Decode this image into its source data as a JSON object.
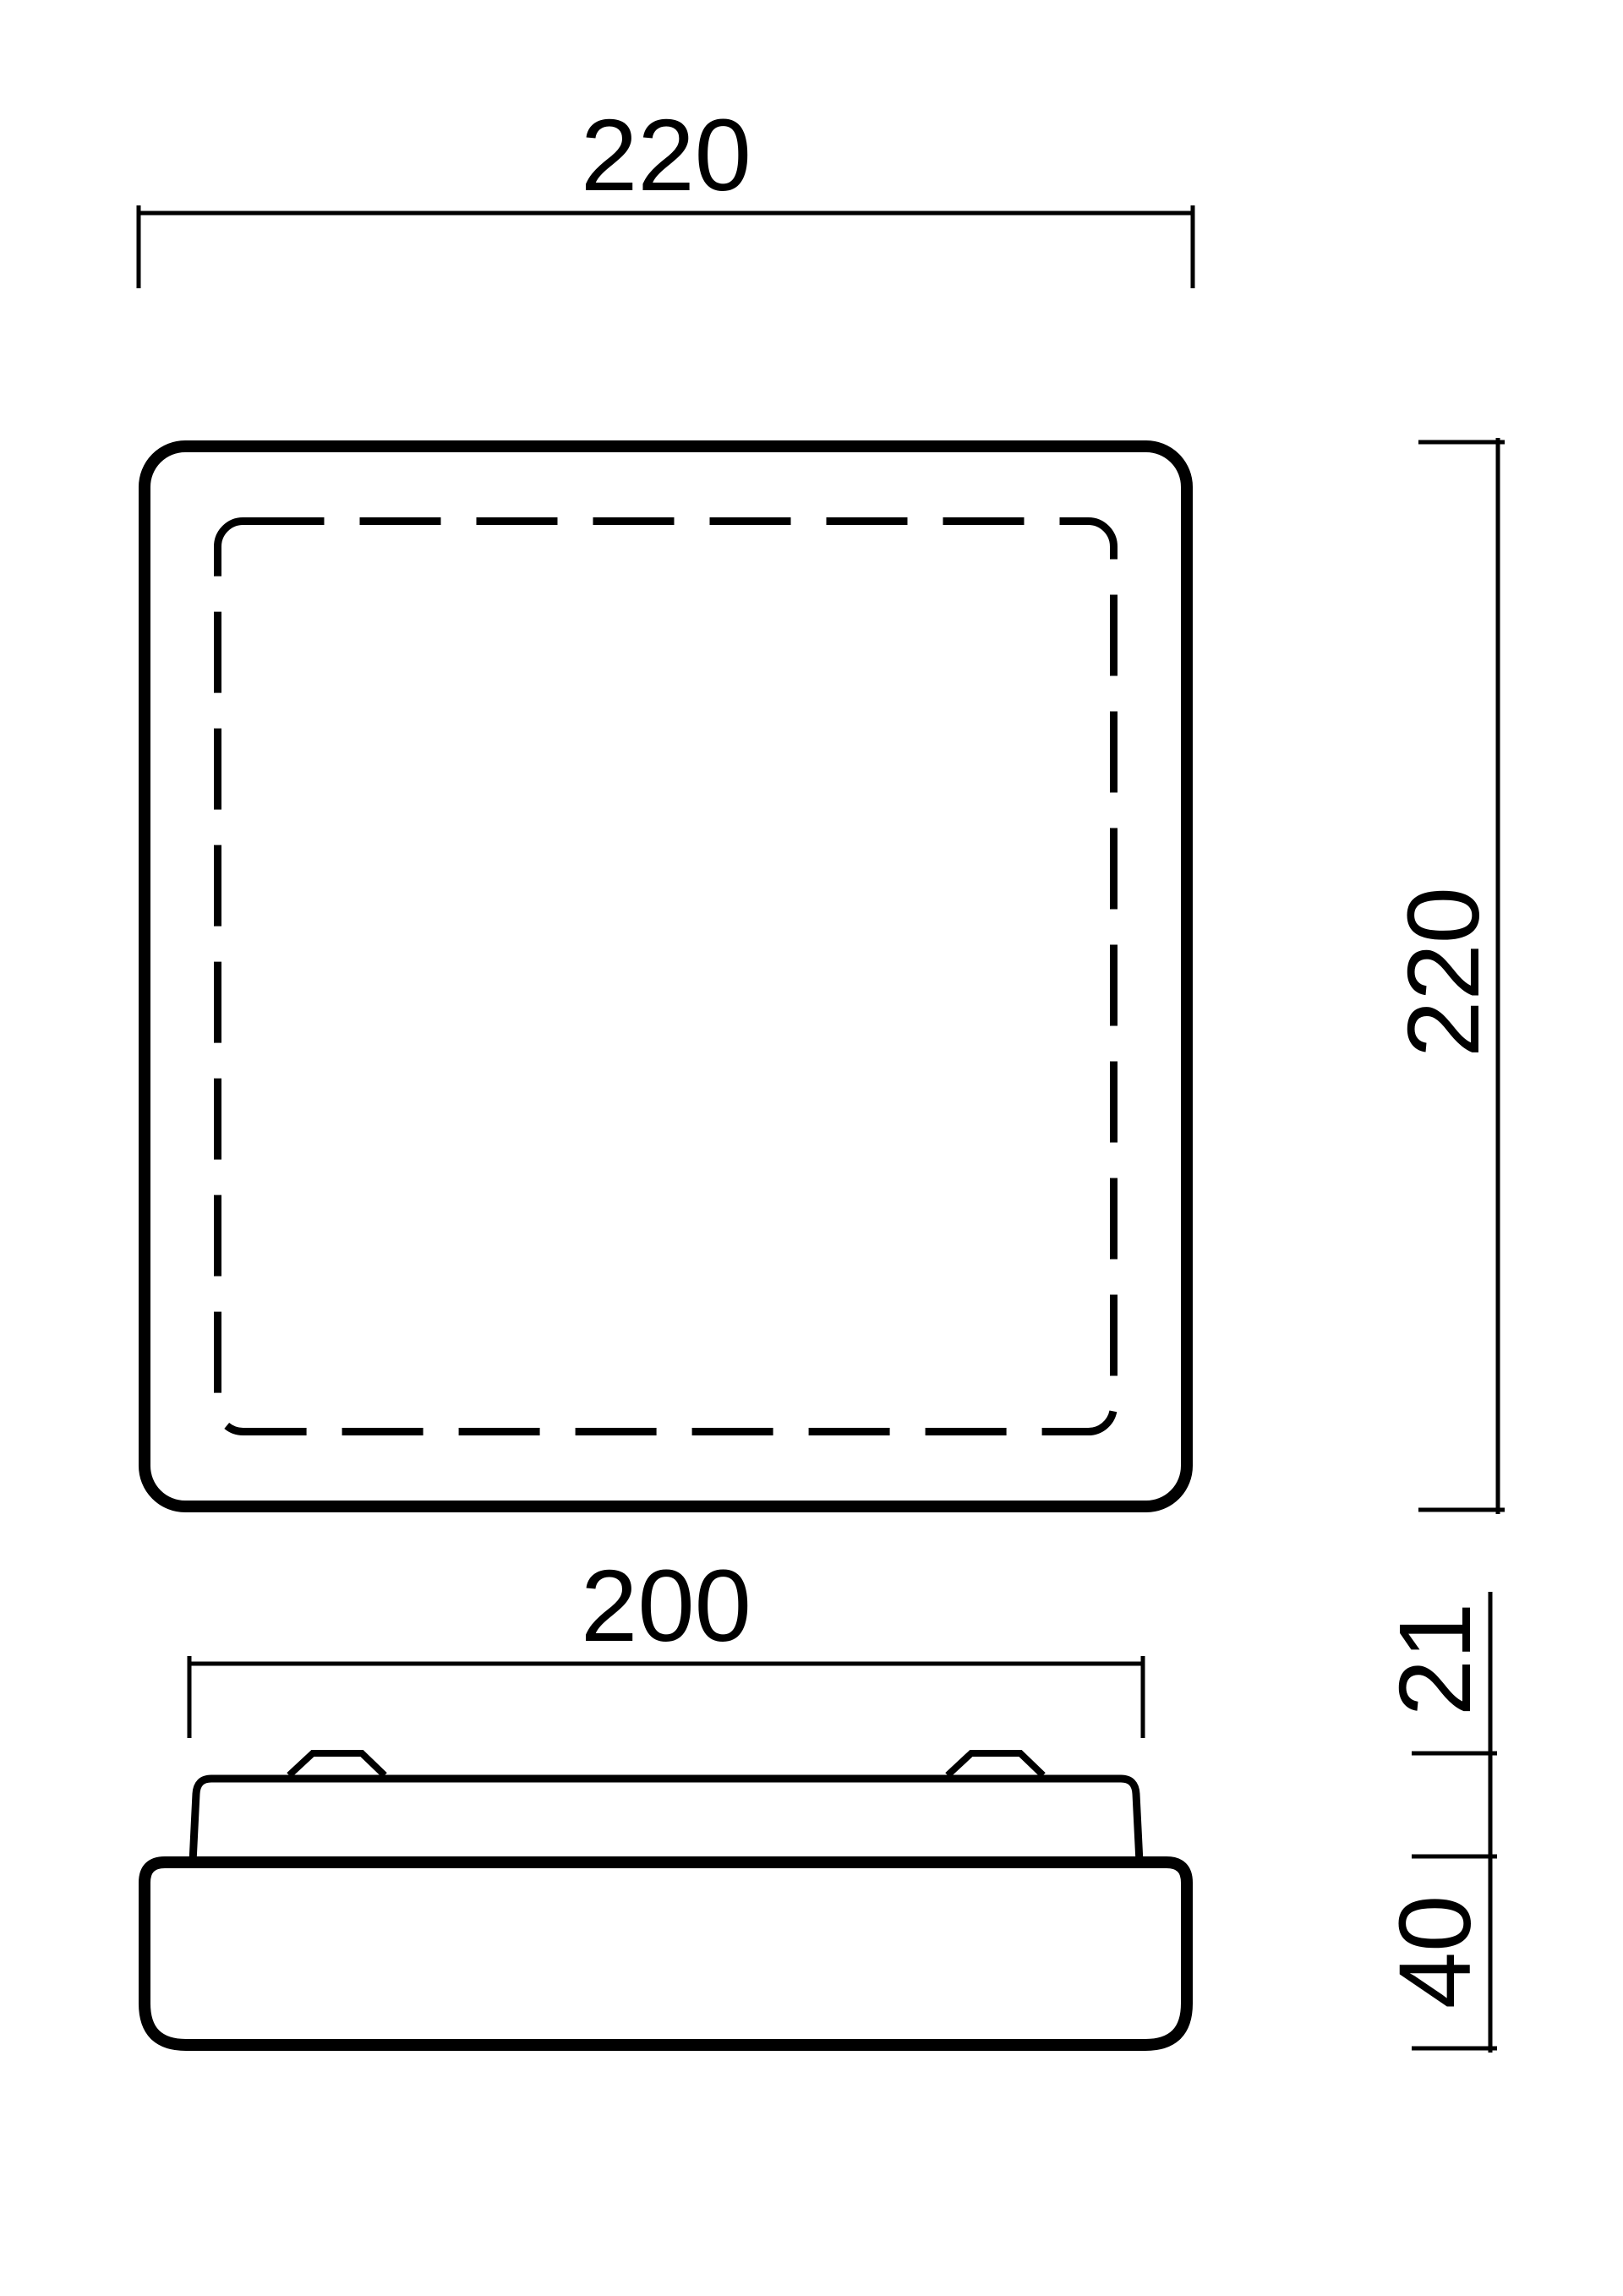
{
  "colors": {
    "background": "#ffffff",
    "line": "#000000"
  },
  "drawing": {
    "dimensions": {
      "top_view_width": "220",
      "top_view_height": "220",
      "front_view_width": "200",
      "front_view_diffuser_height": "21",
      "front_view_base_height": "40"
    }
  }
}
